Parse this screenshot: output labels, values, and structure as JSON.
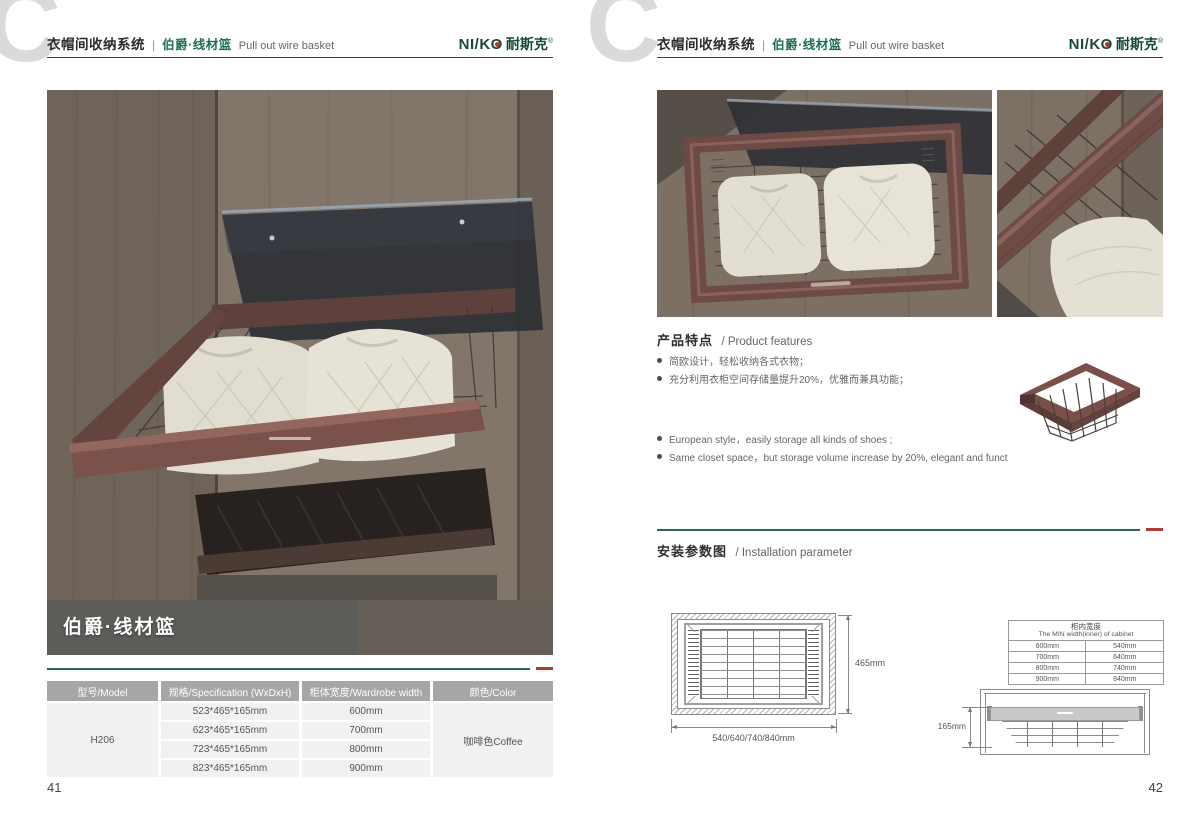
{
  "brand": {
    "logo_en": "NI/K",
    "logo_o": "O",
    "logo_cn": "耐斯克",
    "reg": "®"
  },
  "header": {
    "system_cn": "衣帽间收纳系统",
    "divider": "|",
    "product_cn": "伯爵·线材篮",
    "product_en": "Pull out wire basket"
  },
  "left_page": {
    "photo_label": "伯爵·线材篮",
    "page_number": "41",
    "table": {
      "headers": [
        "型号/Model",
        "规格/Specification (WxDxH)",
        "柜体宽度/Wardrobe width",
        "颜色/Color"
      ],
      "model": "H206",
      "color": "咖啡色Coffee",
      "rows": [
        {
          "spec": "523*465*165mm",
          "width": "600mm"
        },
        {
          "spec": "623*465*165mm",
          "width": "700mm"
        },
        {
          "spec": "723*465*165mm",
          "width": "800mm"
        },
        {
          "spec": "823*465*165mm",
          "width": "900mm"
        }
      ]
    }
  },
  "right_page": {
    "page_number": "42",
    "features": {
      "title_cn": "产品特点",
      "title_en": "/ Product features",
      "bullets_cn": [
        "简欧设计，轻松收纳各式衣物；",
        "充分利用衣柜空间存储量提升20%，优雅而兼具功能；"
      ],
      "bullets_en": [
        "European style，easily storage all kinds of shoes ;",
        "Same closet space，but storage volume increase by 20%, elegant and functional;"
      ]
    },
    "installation": {
      "title_cn": "安装参数图",
      "title_en": "/ Installation parameter",
      "top_view": {
        "depth_label": "465mm",
        "width_label": "540/640/740/840mm"
      },
      "front_view": {
        "height_label": "165mm"
      },
      "min_width_table": {
        "title_cn": "柜内宽度",
        "title_en": "The MIN width(inner) of cabinet",
        "rows": [
          [
            "600mm",
            "540mm"
          ],
          [
            "700mm",
            "640mm"
          ],
          [
            "800mm",
            "740mm"
          ],
          [
            "900mm",
            "840mm"
          ]
        ]
      }
    }
  },
  "colors": {
    "brand_green": "#1e6e54",
    "logo_green": "#17483a",
    "accent_red": "#b23a33",
    "separator_green": "#2a6a52",
    "table_header_bg": "#a6a6a6",
    "table_row_bg": "#f1f1f1"
  }
}
